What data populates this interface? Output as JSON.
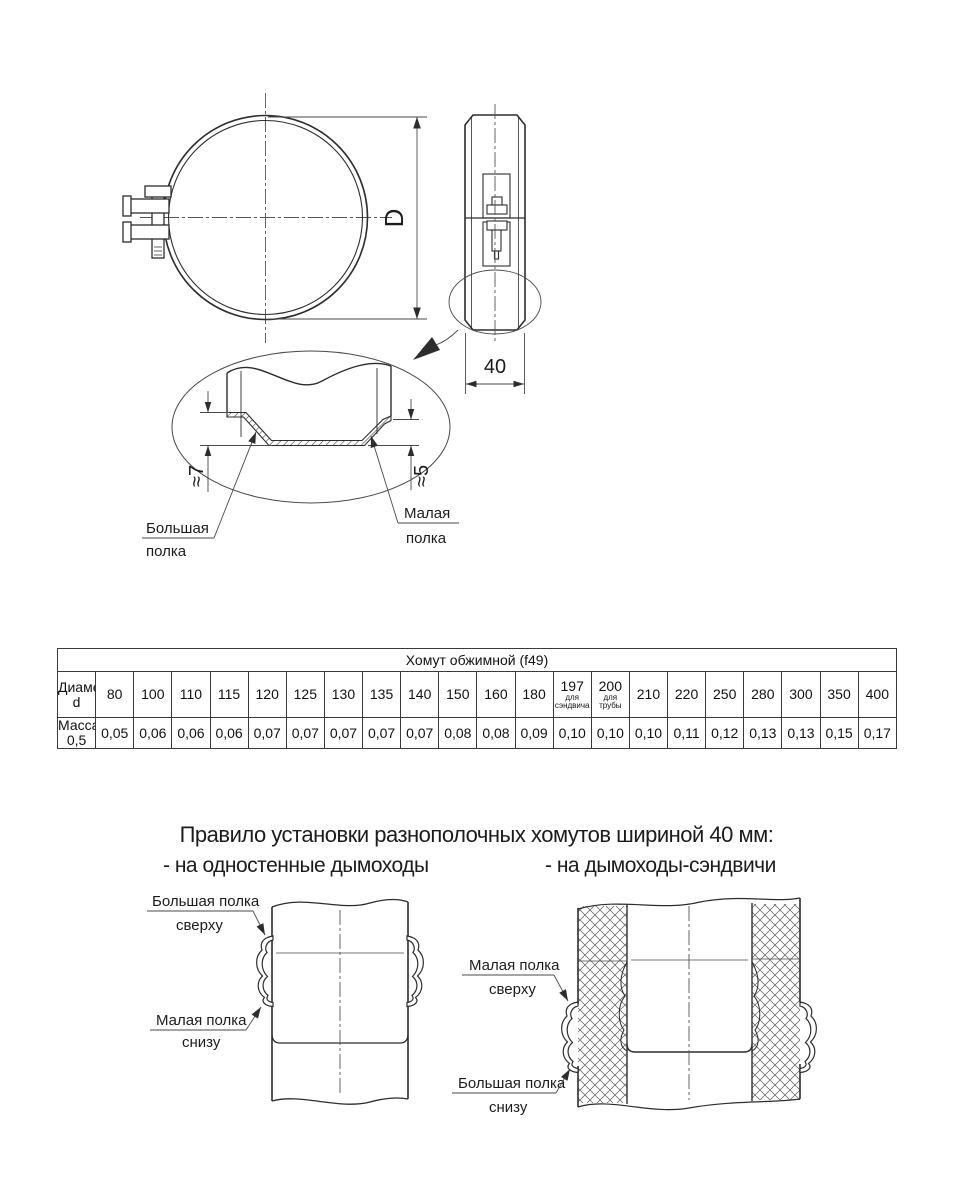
{
  "drawing": {
    "diameter_label": "D",
    "width_label": "40",
    "big_flange_dim": "≈7",
    "small_flange_dim": "≈5",
    "big_flange_label_line1": "Большая",
    "big_flange_label_line2": "полка",
    "small_flange_label_line1": "Малая",
    "small_flange_label_line2": "полка"
  },
  "table": {
    "title": "Хомут обжимной (f49)",
    "diameter_header": "Диаметр d",
    "mass_header": "Масса 0,5",
    "columns": [
      {
        "d": "80",
        "m": "0,05"
      },
      {
        "d": "100",
        "m": "0,06"
      },
      {
        "d": "110",
        "m": "0,06"
      },
      {
        "d": "115",
        "m": "0,06"
      },
      {
        "d": "120",
        "m": "0,07"
      },
      {
        "d": "125",
        "m": "0,07"
      },
      {
        "d": "130",
        "m": "0,07"
      },
      {
        "d": "135",
        "m": "0,07"
      },
      {
        "d": "140",
        "m": "0,07"
      },
      {
        "d": "150",
        "m": "0,08"
      },
      {
        "d": "160",
        "m": "0,08"
      },
      {
        "d": "180",
        "m": "0,09"
      },
      {
        "d": "197",
        "sub": [
          "для",
          "сэндвича"
        ],
        "m": "0,10"
      },
      {
        "d": "200",
        "sub": [
          "для",
          "трубы"
        ],
        "m": "0,10"
      },
      {
        "d": "210",
        "m": "0,10"
      },
      {
        "d": "220",
        "m": "0,11"
      },
      {
        "d": "250",
        "m": "0,12"
      },
      {
        "d": "280",
        "m": "0,13"
      },
      {
        "d": "300",
        "m": "0,13"
      },
      {
        "d": "350",
        "m": "0,15"
      },
      {
        "d": "400",
        "m": "0,17"
      }
    ]
  },
  "rules": {
    "title": "Правило установки разнополочных хомутов шириной 40 мм:",
    "single_wall_heading": "- на одностенные дымоходы",
    "sandwich_heading": "- на дымоходы-сэндвичи",
    "single_wall": {
      "top_label_line1": "Большая полка",
      "top_label_line2": "сверху",
      "bottom_label_line1": "Малая полка",
      "bottom_label_line2": "снизу"
    },
    "sandwich": {
      "top_label_line1": "Малая полка",
      "top_label_line2": "сверху",
      "bottom_label_line1": "Большая полка",
      "bottom_label_line2": "снизу"
    }
  },
  "colors": {
    "line": "#2d2d2d",
    "thin_line": "#4a4a4a",
    "background": "#ffffff"
  }
}
